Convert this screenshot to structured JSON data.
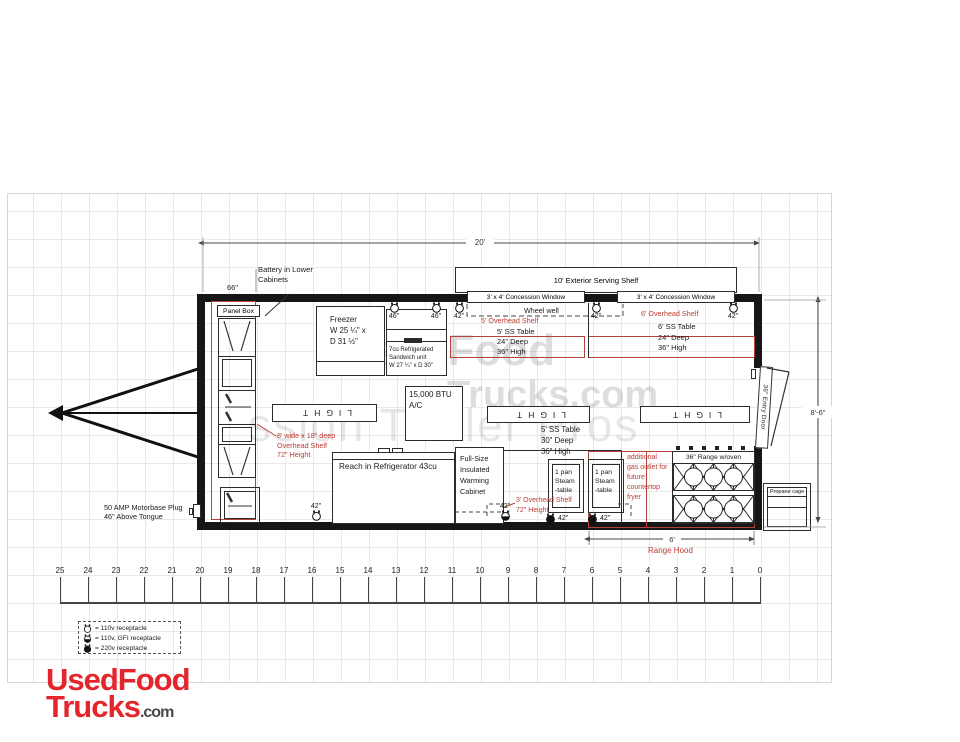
{
  "colors": {
    "red_text": "#bf3b32",
    "red_line": "#b5423b",
    "wall": "#161616",
    "logo_red": "#e4252b",
    "logo_gray": "#474747",
    "grid": "#e7eae7"
  },
  "watermarks": {
    "wm1a": "UsedFood",
    "wm1b": "Trucks.com",
    "wm2": "ssion Trailer Pros"
  },
  "dims": {
    "length": "20'",
    "height": "8'-6\"",
    "front": "66\"",
    "hood": "6'"
  },
  "exterior": {
    "serving_shelf": "10' Exterior Serving Shelf",
    "window1": "3' x 4' Concession Window",
    "window2": "3' x 4' Concession Window",
    "wheel_well": "Wheel well",
    "propane": "Propane cage",
    "entry_door": "36\" Entry Door",
    "motorbase1": "50 AMP Motorbase Plug",
    "motorbase2": "46\" Above Tongue",
    "battery1": "Battery in Lower",
    "battery2": "Cabinets",
    "panel_box": "Panel Box"
  },
  "equipment": {
    "freezer": {
      "l1": "Freezer",
      "l2": "W 25 ¼\" x",
      "l3": "D 31 ½\""
    },
    "sandwich": {
      "l1": "7cu Refrigerated",
      "l2": "Sandwich unit",
      "l3": "W 27 ¼\" x D 30\""
    },
    "ac": {
      "l1": "15,000 BTU",
      "l2": "A/C"
    },
    "reach_in": "Reach in Refrigerator 43cu",
    "warming": {
      "l1": "Full-Size",
      "l2": "Insulated",
      "l3": "Warming",
      "l4": "Cabinet"
    },
    "steam": {
      "l1": "1 pan",
      "l2": "Steam",
      "l3": "-table"
    },
    "range": "36\" Range w/oven",
    "range_hood": "Range Hood",
    "light": "LIGHT"
  },
  "shelves": {
    "oh5": "5' Overhead Shelf",
    "oh6": "6' Overhead Shelf",
    "t5": {
      "l1": "5' SS Table",
      "l2": "24\" Deep",
      "l3": "36\" High"
    },
    "t6": {
      "l1": "6' SS Table",
      "l2": "24\" Deep",
      "l3": "36\" High"
    },
    "t5b": {
      "l1": "5' SS Table",
      "l2": "30\" Deep",
      "l3": "36\" High"
    },
    "oh8": {
      "l1": "8' wide x 18\" deep",
      "l2": "Overhead Shelf",
      "l3": "72\" Height"
    },
    "oh3": {
      "l1": "3' Overhead Shelf",
      "l2": "72\" Height"
    },
    "gas": {
      "l1": "additional",
      "l2": "gas outlet for",
      "l3": "future",
      "l4": "countertop",
      "l5": "fryer"
    }
  },
  "receptacles": [
    {
      "label": "46\"",
      "type": "110v"
    },
    {
      "label": "46\"",
      "type": "110v"
    },
    {
      "label": "42\"",
      "type": "110v"
    },
    {
      "label": "42\"",
      "type": "110v"
    },
    {
      "label": "42\"",
      "type": "110v"
    },
    {
      "label": "42\"",
      "type": "110v"
    },
    {
      "label": "42\"",
      "type": "gfi"
    },
    {
      "label": "42\"",
      "type": "220v"
    },
    {
      "label": "42\"",
      "type": "220v"
    }
  ],
  "legend": [
    {
      "type": "110v",
      "text": "= 110v receptacle"
    },
    {
      "type": "gfi",
      "text": "= 110v, GFI receptacle"
    },
    {
      "type": "220v",
      "text": "= 220v receptacle"
    }
  ],
  "ruler": {
    "numbers": [
      25,
      24,
      23,
      22,
      21,
      20,
      19,
      18,
      17,
      16,
      15,
      14,
      13,
      12,
      11,
      10,
      9,
      8,
      7,
      6,
      5,
      4,
      3,
      2,
      1,
      0
    ]
  },
  "logo": {
    "l1": "UsedFood",
    "l2": "Trucks",
    "suffix": ".com"
  }
}
